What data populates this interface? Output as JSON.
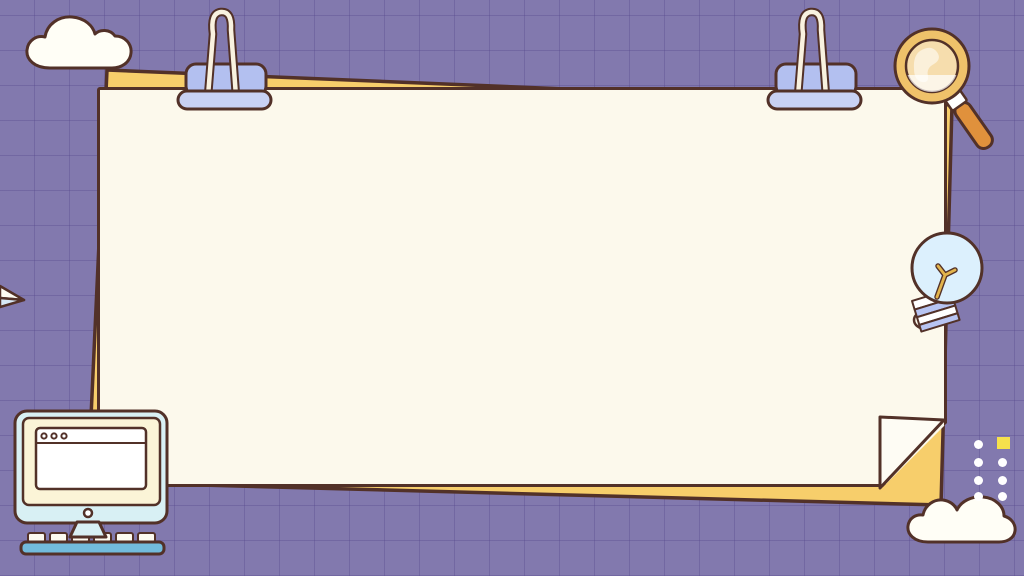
{
  "scene": {
    "kind": "decorative stationery-themed slide background",
    "text_content": "none",
    "elements": [
      "cloud-top-left",
      "binder-clip-left",
      "binder-clip-right",
      "paper-sheet",
      "yellow-backing-sheet",
      "folded-corner",
      "magnifying-glass",
      "light-bulb",
      "computer-monitor",
      "paper-plane",
      "dot-grid",
      "accent-square",
      "cloud-bottom-right"
    ]
  },
  "colors": {
    "bg": "#8279AE",
    "grid": "rgba(84,70,140,0.35)",
    "outline": "#523128",
    "paper": "#FCF9EC",
    "backing": "#F7CE6B",
    "flap": "#FEFCF4",
    "clip_body": "#B3C0F0",
    "clip_bar": "#C8D1F4",
    "clip_wire": "#F9F2DF",
    "lens_rim": "#EFC26A",
    "lens_glass": "rgba(255,255,255,0.45)",
    "handle": "#E0913C",
    "collar": "#FFFFFF",
    "bulb": "#DCF0FD",
    "filament": "#E3B44C",
    "stripe": "#B7C4F2",
    "monitor_frame": "#D8F0F4",
    "monitor_screen": "#FBF4D7",
    "window_white": "#FFFFFF",
    "keyboard": "#72BBDC",
    "key": "#FDFAF0",
    "cloud": "#FFFEF6",
    "dot": "#FFFFFF",
    "accent_square": "#F6E14C",
    "plane_top": "#FDFBF2",
    "plane_bottom": "#D7E8F5"
  }
}
